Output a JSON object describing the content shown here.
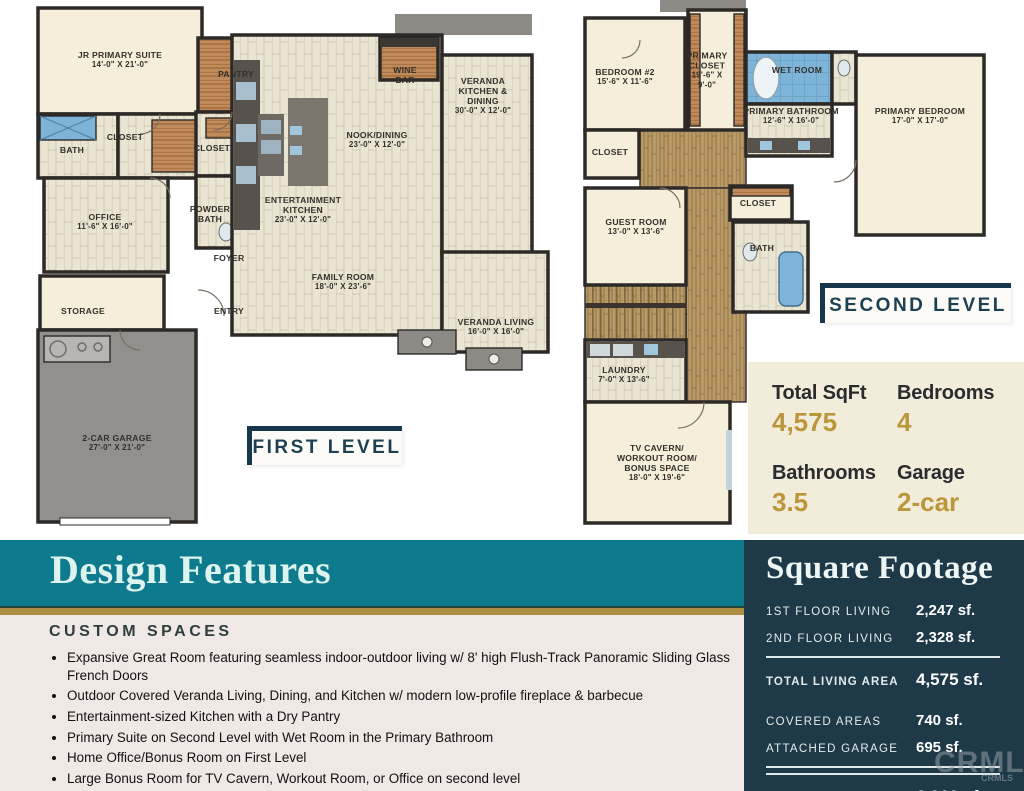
{
  "first_level": {
    "badge": "FIRST LEVEL",
    "rooms": {
      "jr_suite": {
        "name": "JR PRIMARY SUITE",
        "dims": "14'-0\" X 21'-0\""
      },
      "bath": {
        "name": "BATH"
      },
      "closet_a": {
        "name": "CLOSET"
      },
      "pantry": {
        "name": "PANTRY"
      },
      "closet_b": {
        "name": "CLOSET"
      },
      "powder_bath": {
        "name": "POWDER\nBATH"
      },
      "office": {
        "name": "OFFICE",
        "dims": "11'-6\" X 16'-0\""
      },
      "foyer": {
        "name": "FOYER"
      },
      "storage": {
        "name": "STORAGE"
      },
      "entry": {
        "name": "ENTRY"
      },
      "garage": {
        "name": "2-CAR GARAGE",
        "dims": "27'-0\" X 21'-0\""
      },
      "wine_bar": {
        "name": "WINE\nBAR"
      },
      "veranda_kitchen": {
        "name": "VERANDA\nKITCHEN &\nDINING",
        "dims": "30'-0\" X 12'-0\""
      },
      "nook": {
        "name": "NOOK/DINING",
        "dims": "23'-0\" X 12'-0\""
      },
      "ent_kitchen": {
        "name": "ENTERTAINMENT\nKITCHEN",
        "dims": "23'-0\" X 12'-0\""
      },
      "family_room": {
        "name": "FAMILY ROOM",
        "dims": "18'-0\" X 23'-6\""
      },
      "veranda_living": {
        "name": "VERANDA LIVING",
        "dims": "16'-0\" X 16'-0\""
      }
    }
  },
  "second_level": {
    "badge": "SECOND LEVEL",
    "rooms": {
      "bedroom2": {
        "name": "BEDROOM #2",
        "dims": "15'-6\" X 11'-6\""
      },
      "primary_closet": {
        "name": "PRIMARY\nCLOSET",
        "dims": "19'-6\" X\n9'-0\""
      },
      "wet_room": {
        "name": "WET ROOM"
      },
      "primary_bathroom": {
        "name": "PRIMARY BATHROOM",
        "dims": "12'-6\" X 16'-0\""
      },
      "primary_bedroom": {
        "name": "PRIMARY BEDROOM",
        "dims": "17'-0\" X 17'-0\""
      },
      "closet_a": {
        "name": "CLOSET"
      },
      "guest_room": {
        "name": "GUEST ROOM",
        "dims": "13'-0\" X 13'-6\""
      },
      "closet_b": {
        "name": "CLOSET"
      },
      "bath": {
        "name": "BATH"
      },
      "laundry": {
        "name": "LAUNDRY",
        "dims": "7'-0\" X 13'-6\""
      },
      "tv_cavern": {
        "name": "TV CAVERN/\nWORKOUT ROOM/\nBONUS SPACE",
        "dims": "18'-0\" X 19'-6\""
      }
    }
  },
  "stats": {
    "total_sqft": {
      "label": "Total SqFt",
      "value": "4,575"
    },
    "bedrooms": {
      "label": "Bedrooms",
      "value": "4"
    },
    "bathrooms": {
      "label": "Bathrooms",
      "value": "3.5"
    },
    "garage": {
      "label": "Garage",
      "value": "2-car"
    }
  },
  "design_features": {
    "title": "Design Features",
    "subtitle": "CUSTOM SPACES",
    "bullets": [
      "Expansive Great Room featuring seamless indoor-outdoor living w/ 8' high Flush-Track Panoramic Sliding Glass French Doors",
      "Outdoor Covered Veranda Living, Dining, and Kitchen w/ modern low-profile fireplace & barbecue",
      "Entertainment-sized Kitchen with a Dry Pantry",
      "Primary Suite on Second Level with Wet Room in the Primary Bathroom",
      "Home Office/Bonus Room on First Level",
      "Large Bonus Room for TV Cavern, Workout Room, or Office on second level",
      "Abundant Storage and Closet Space"
    ]
  },
  "square_footage": {
    "title": "Square Footage",
    "rows_top": [
      {
        "label": "1ST FLOOR LIVING",
        "value": "2,247 sf."
      },
      {
        "label": "2ND FLOOR LIVING",
        "value": "2,328 sf."
      }
    ],
    "total_living": {
      "label": "TOTAL LIVING AREA",
      "value": "4,575 sf."
    },
    "rows_mid": [
      {
        "label": "COVERED AREAS",
        "value": "740 sf."
      },
      {
        "label": "ATTACHED GARAGE",
        "value": "695 sf."
      }
    ],
    "total_roof": {
      "label": "TOTAL UNDER ROOF",
      "value": "6,010 sf."
    }
  },
  "watermark": {
    "large": "CRMLS",
    "small": "CRMLS"
  },
  "colors": {
    "teal": "#0e7a8e",
    "gold": "#ad8d41",
    "navy": "#1e3947",
    "cream": "#f2ecda",
    "blush": "#f0e8e4",
    "gold_text": "#bb963b"
  }
}
